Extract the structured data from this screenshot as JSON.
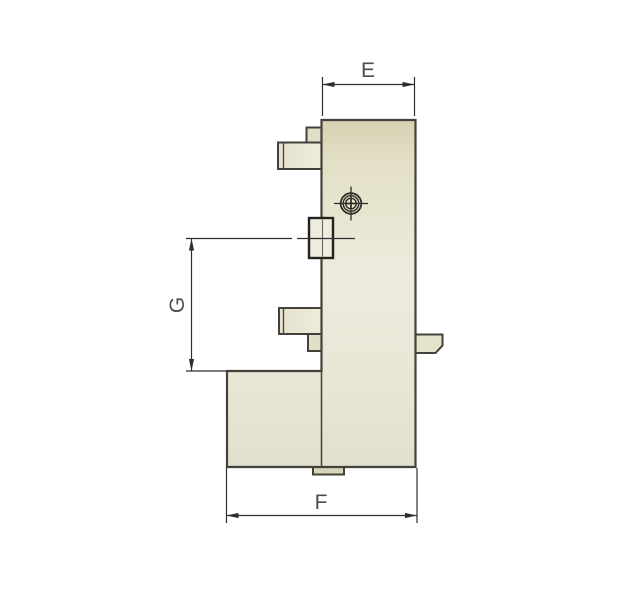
{
  "drawing": {
    "kind": "technical-side-view",
    "dimensions": {
      "e": {
        "label": "E"
      },
      "g": {
        "label": "G"
      },
      "f": {
        "label": "F"
      }
    },
    "icons": {
      "screw_head": "crosshair-screw-icon"
    },
    "colors": {
      "background": "#ffffff",
      "body_fill_top": "#d7d2b2",
      "body_fill_mid": "#edebdd",
      "body_fill_bottom": "#e2dfcc",
      "block_fill": "#eae7d6",
      "block_end_fill": "#d9d5bb",
      "key_block_fill": "#eeecdf",
      "step_fill": "#e2dfc9",
      "tab_fill": "#e6e3cd",
      "foot_fill": "#d8d4ba",
      "outline": "#43423a",
      "key_outline": "#23221c",
      "dimension_line": "#2e2e2e",
      "label_text": "#4d4d4d"
    }
  }
}
